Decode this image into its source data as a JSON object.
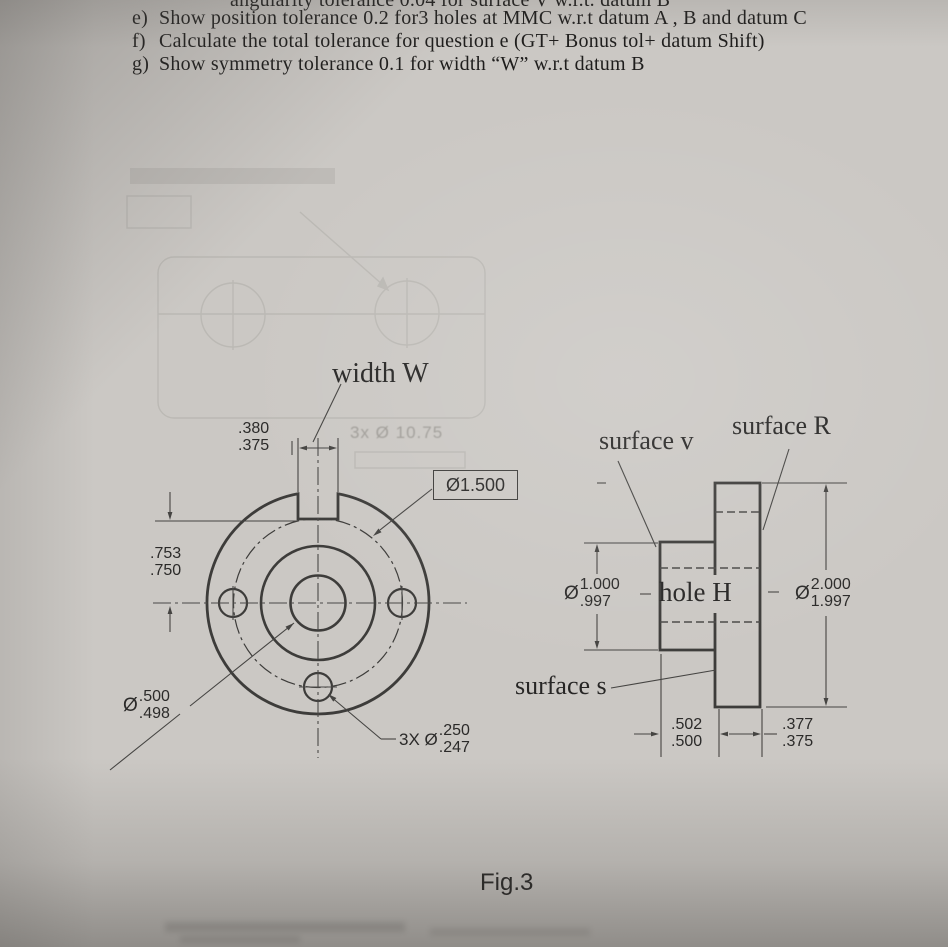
{
  "questions": {
    "top_fragment": "angularity tolerance 0.04 for surface V w.r.t. datum B",
    "items": [
      {
        "marker": "e)",
        "text": "Show position tolerance 0.2 for3 holes at MMC w.r.t datum A , B and datum C"
      },
      {
        "marker": "f)",
        "text": "Calculate the total tolerance for question e (GT+ Bonus tol+ datum Shift)"
      },
      {
        "marker": "g)",
        "text": "Show symmetry tolerance 0.1 for width “W” w.r.t datum B"
      }
    ]
  },
  "front_view": {
    "width_w": "width W",
    "slot_width": {
      "upper": ".380",
      "lower": ".375"
    },
    "slot_depth": {
      "upper": ".753",
      "lower": ".750"
    },
    "bolt_circle_callout": "Ø1.500",
    "center_hole": {
      "prefix": "Ø",
      "upper": ".500",
      "lower": ".498"
    },
    "small_holes": {
      "prefix": "3X Ø",
      "upper": ".250",
      "lower": ".247"
    }
  },
  "side_view": {
    "surface_v": "surface v",
    "surface_r": "surface R",
    "surface_s": "surface s",
    "hole_h": "hole H",
    "hub_diameter": {
      "prefix": "Ø",
      "upper": "1.000",
      "lower": ".997"
    },
    "flange_diameter": {
      "prefix": "Ø",
      "upper": "2.000",
      "lower": "1.997"
    },
    "hub_length": {
      "upper": ".502",
      "lower": ".500"
    },
    "flange_thickness": {
      "upper": ".377",
      "lower": ".375"
    }
  },
  "figure_caption": "Fig.3",
  "ghost": {
    "fragment": "3x Ø 10.75"
  },
  "colors": {
    "paper": "#cbc8c4",
    "ink": "#3d3c3a",
    "text": "#1e1d1c"
  }
}
